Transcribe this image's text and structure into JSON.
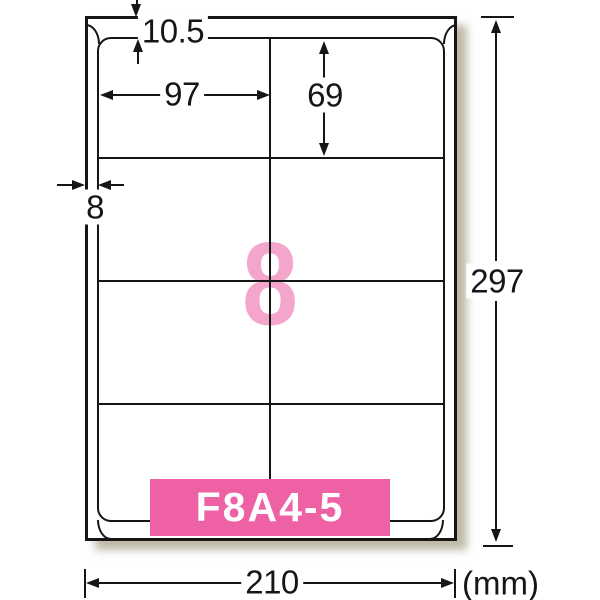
{
  "diagram": {
    "product_code": "F8A4-5",
    "label_count": "8",
    "unit": "(mm)",
    "dimensions": {
      "sheet_width": "210",
      "sheet_height": "297",
      "top_margin": "10.5",
      "side_margin": "8",
      "label_width": "97",
      "label_height": "69"
    },
    "grid": {
      "columns": 2,
      "rows": 4
    },
    "colors": {
      "badge_pink": "#ee61a5",
      "count_pink": "#f3a5cc",
      "line_black": "#161616"
    }
  }
}
